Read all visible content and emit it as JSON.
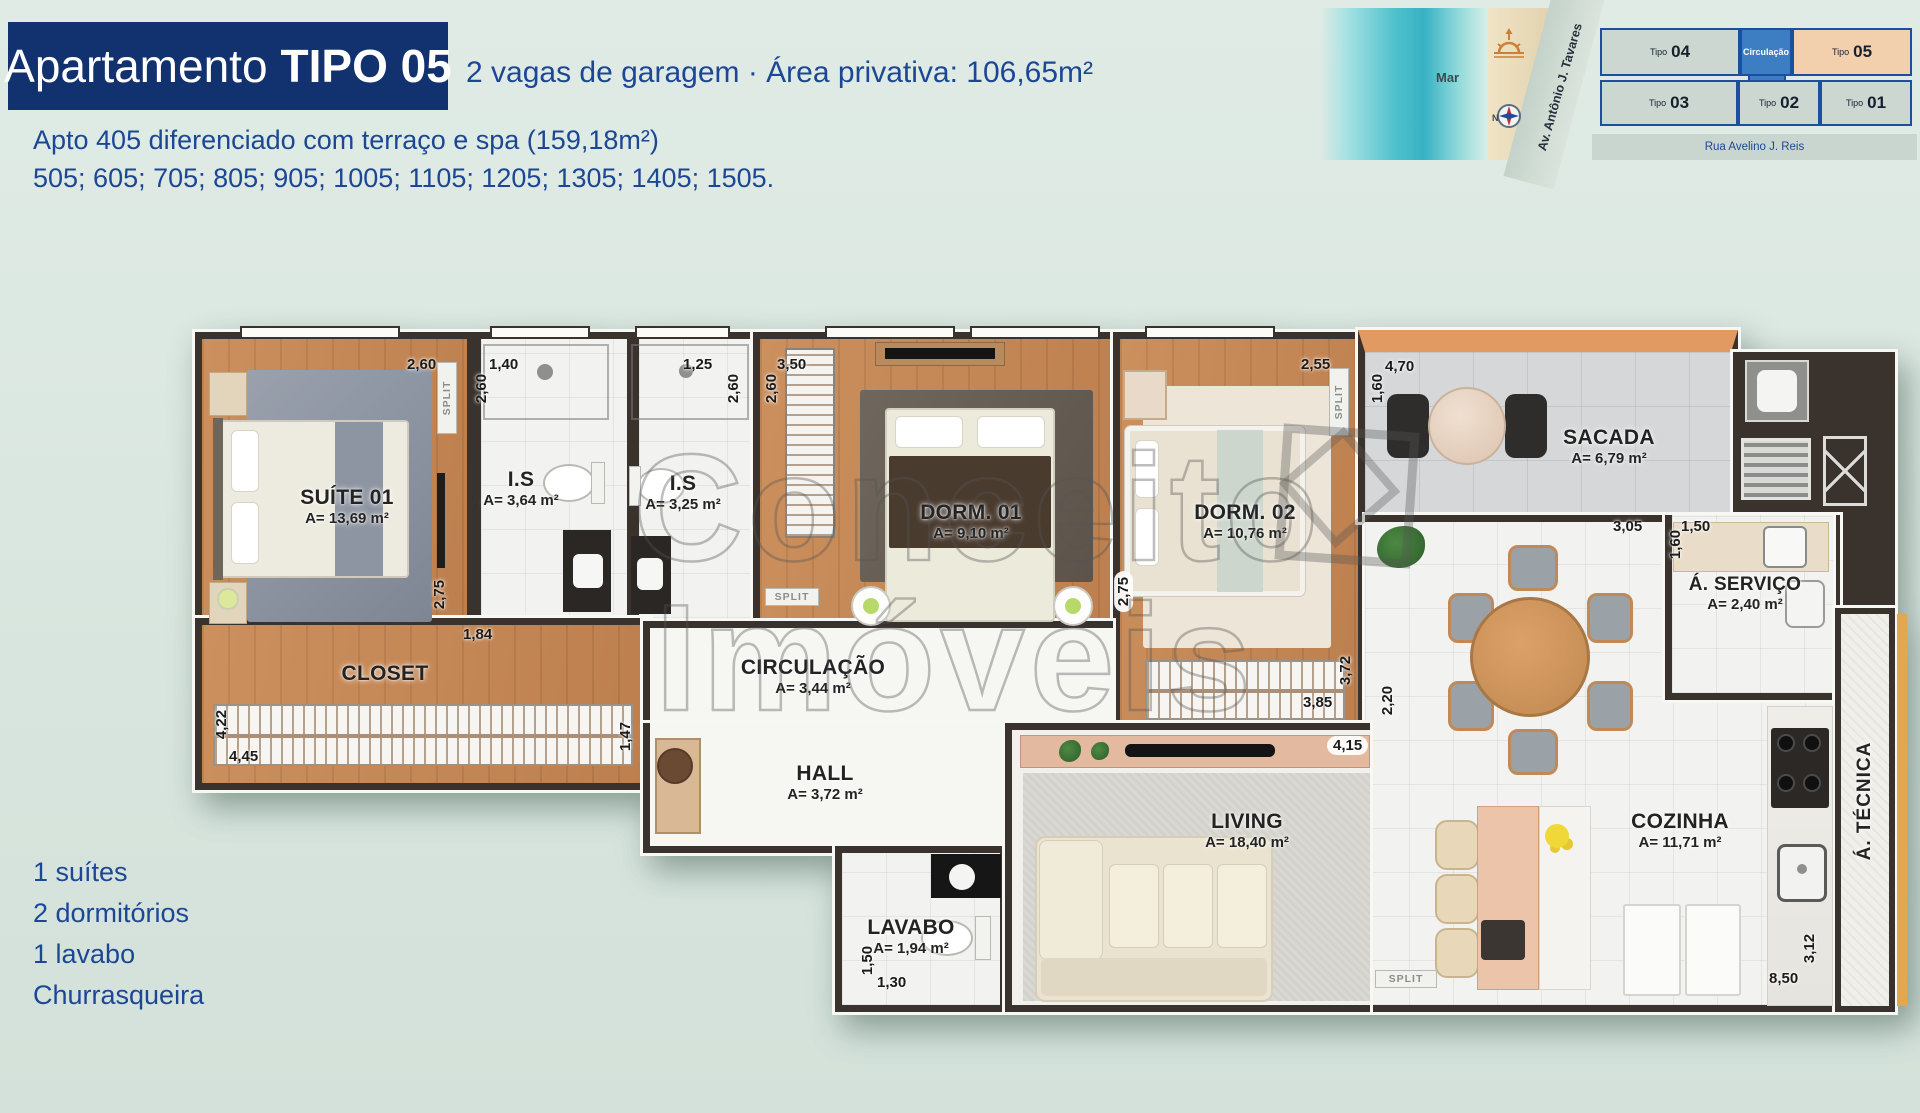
{
  "header": {
    "title_regular": "Apartamento",
    "title_bold": "TIPO 05",
    "subtitle": "2 vagas de garagem · Área privativa: 106,65m²",
    "note_line1": "Apto 405 diferenciado com terraço e spa (159,18m²)",
    "note_line2": "505; 605; 705; 805; 905; 1005; 1105; 1205; 1305; 1405; 1505."
  },
  "features": [
    "1 suítes",
    "2 dormitórios",
    "1 lavabo",
    "Churrasqueira"
  ],
  "minimap": {
    "sea_label": "Mar",
    "avenue_label": "Av. Antônio J. Tavares",
    "street_label": "Rua Avelino J. Reis",
    "circulation_label": "Circulação",
    "compass_n": "N",
    "units": {
      "u04": {
        "prefix": "Tipo",
        "num": "04"
      },
      "u05": {
        "prefix": "Tipo",
        "num": "05"
      },
      "u03": {
        "prefix": "Tipo",
        "num": "03"
      },
      "u02": {
        "prefix": "Tipo",
        "num": "02"
      },
      "u01": {
        "prefix": "Tipo",
        "num": "01"
      }
    },
    "colors": {
      "unit": "#cbd7d0",
      "highlight": "#f2cfad",
      "circulation": "#3d7ec2",
      "border": "#1d4fa0"
    }
  },
  "rooms": {
    "suite": {
      "name": "SUÍTE 01",
      "area": "A= 13,69 m²"
    },
    "is1": {
      "name": "I.S",
      "area": "A= 3,64 m²"
    },
    "is2": {
      "name": "I.S",
      "area": "A= 3,25 m²"
    },
    "dorm1": {
      "name": "DORM. 01",
      "area": "A= 9,10 m²"
    },
    "dorm2": {
      "name": "DORM. 02",
      "area": "A= 10,76 m²"
    },
    "sacada": {
      "name": "SACADA",
      "area": "A= 6,79 m²"
    },
    "closet": {
      "name": "CLOSET"
    },
    "circulacao": {
      "name": "CIRCULAÇÃO",
      "area": "A= 3,44 m²"
    },
    "hall": {
      "name": "HALL",
      "area": "A= 3,72 m²"
    },
    "lavabo": {
      "name": "LAVABO",
      "area": "A= 1,94 m²"
    },
    "living": {
      "name": "LIVING",
      "area": "A= 18,40 m²"
    },
    "servico": {
      "name": "Á. SERVIÇO",
      "area": "A= 2,40 m²"
    },
    "cozinha": {
      "name": "COZINHA",
      "area": "A= 11,71 m²"
    },
    "tecnica": {
      "name": "Á. TÉCNICA"
    }
  },
  "dims": [
    "2,60",
    "1,40",
    "2,60",
    "1,25",
    "2,60",
    "3,50",
    "2,60",
    "2,55",
    "4,70",
    "1,60",
    "2,75",
    "1,84",
    "4,22",
    "4,45",
    "1,47",
    "2,75",
    "3,85",
    "3,72",
    "4,15",
    "2,20",
    "3,05",
    "1,50",
    "1,60",
    "1,50",
    "1,30",
    "8,50",
    "3,12"
  ],
  "split_label": "SPLIT",
  "watermark": {
    "line1": "Conceito",
    "line2": "Imóveis"
  }
}
